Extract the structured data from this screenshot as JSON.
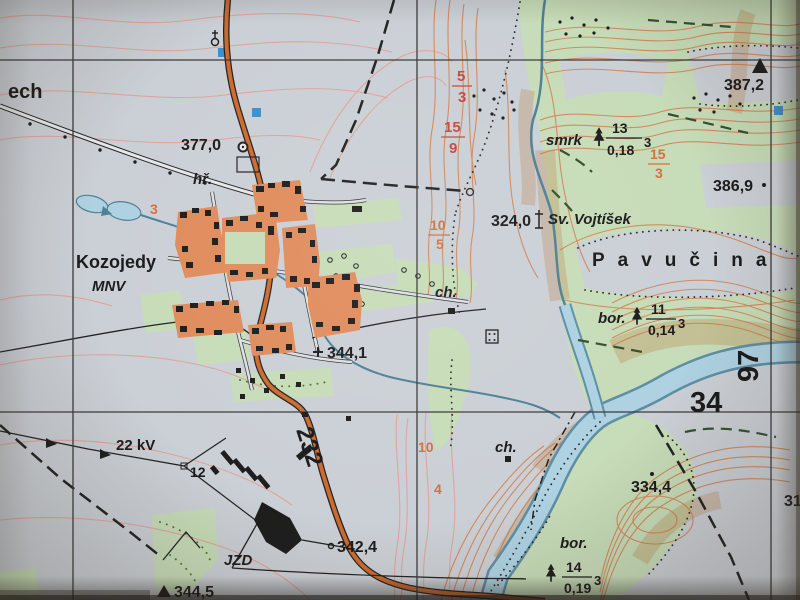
{
  "map": {
    "labels": {
      "partial_left": "ech",
      "town": "Kozojedy",
      "town_sub": "MNV",
      "cemetery": "hř.",
      "forest_name": "Pavučina",
      "chapel_name": "Sv. Vojtíšek",
      "farm": "JZD",
      "power_line": "22 kV",
      "pole_number": "12",
      "road_number": "232",
      "cottage1": "ch.",
      "cottage2": "ch.",
      "grid_east": "97",
      "grid_north": "34"
    },
    "heights": {
      "h377": "377,0",
      "h324": "324,0",
      "h387": "387,2",
      "h386": "386,9",
      "h344_1": "344,1",
      "h342": "342,4",
      "h334": "334,4",
      "h344_5": "344,5",
      "h319": "319"
    },
    "forest_stands": {
      "s1": {
        "sp": "smrk",
        "n": "13",
        "d": "0,18",
        "e": "3"
      },
      "s2": {
        "sp": "bor.",
        "n": "11",
        "d": "0,14",
        "e": "3"
      },
      "s3": {
        "sp": "bor.",
        "n": "14",
        "d": "0,19",
        "e": "3"
      }
    },
    "contour_fractions": {
      "f1n": "5",
      "f1d": "3",
      "f2n": "15",
      "f2d": "9",
      "f3n": "15",
      "f3d": "3",
      "f4n": "10",
      "f4d": "5",
      "f5": "10",
      "f6": "4",
      "f7": "3"
    },
    "colors": {
      "paper": "#cbd0d6",
      "forest_green": "#c7dcb8",
      "built_up": "#e08c5c",
      "road_fill": "#cd6a2e",
      "water_fill": "#aed2e2",
      "water_edge": "#5d8ea4",
      "contour_orange": "#d18a5e",
      "contour_pink": "#e0a49b",
      "label_red": "#c34a3c",
      "ink": "#1d1d1d"
    }
  }
}
